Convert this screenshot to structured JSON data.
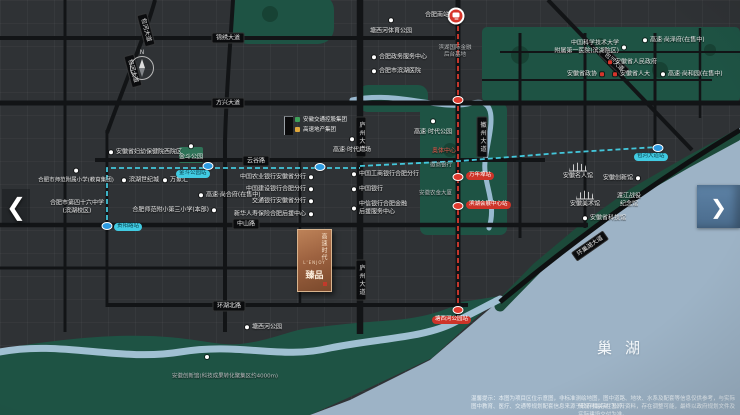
{
  "lake_label": "巢湖",
  "compass_n": "N",
  "nav": {
    "prev": "❮",
    "next": "❯"
  },
  "plaque": {
    "vertical": "高速时代",
    "latin": "L'ENJOY",
    "name": "臻品"
  },
  "developer_logos": [
    {
      "label": "安徽交通控股集团",
      "color": "#3fa05a",
      "x": 295,
      "y": 119
    },
    {
      "label": "高速地产集团",
      "color": "#e0a83c",
      "x": 295,
      "y": 129
    }
  ],
  "disclaimer": {
    "line1": "温馨提示：本图为项目区位示意图，非标准测绘地图，图中道路、地块、水系及配套等信息仅供参考，与实际情况可能存在差异。",
    "line2": "图中教育、医疗、交通等规划配套信息来源于政府相关部门公开资料，存在调整可能，最终以政府规划文件及实际建设交付为准。"
  },
  "colors": {
    "metro_cyan": "#45cfe4",
    "metro_red": "#e33d30",
    "park": "#1e5344",
    "lake": "#9db3c6",
    "accent_red": "#d6352b"
  },
  "map": {
    "pois": [
      {
        "n": "hefei-south-station-label",
        "t": "合肥南站",
        "x": 449,
        "y": 15,
        "m": "none",
        "a": "r"
      },
      {
        "n": "tangxihe-sports-park-label",
        "t": "塘西河体育公园",
        "x": 391,
        "y": 31,
        "m": "wt",
        "a": "c"
      },
      {
        "n": "gov-service-center-label",
        "t": "合肥政务服务中心",
        "x": 372,
        "y": 57,
        "m": "wl",
        "a": "l"
      },
      {
        "n": "binhu-hospital-label",
        "t": "合肥市滨湖医院",
        "x": 372,
        "y": 71,
        "m": "wl",
        "a": "l"
      },
      {
        "n": "financial-backoffice-label",
        "t": "滨湖国际金融\n后台基地",
        "x": 455,
        "y": 52,
        "m": "none",
        "a": "c",
        "cls": "grey sm"
      },
      {
        "n": "ustc-hospital-label",
        "t": "中国科学技术大学\n附属第一医院(滨湖院区)",
        "x": 626,
        "y": 47,
        "m": "wr",
        "a": "r"
      },
      {
        "n": "gaosu-shangzefu-label",
        "t": "高速·尚泽府(在售中)",
        "x": 643,
        "y": 40,
        "m": "wl",
        "a": "l"
      },
      {
        "n": "anhui-gov-label",
        "t": "安徽省人民政府",
        "x": 608,
        "y": 62,
        "m": "rl",
        "a": "l"
      },
      {
        "n": "anhui-zhengxie-label",
        "t": "安徽省政协",
        "x": 604,
        "y": 74,
        "m": "rr",
        "a": "r"
      },
      {
        "n": "anhui-renda-label",
        "t": "安徽省人大",
        "x": 613,
        "y": 74,
        "m": "rl",
        "a": "l"
      },
      {
        "n": "gaosu-shangheyuan-label",
        "t": "高速·尚和园(在售中)",
        "x": 661,
        "y": 74,
        "m": "wl",
        "a": "l"
      },
      {
        "n": "abc-bank-label",
        "t": "中国农业银行安徽省分行",
        "x": 313,
        "y": 177,
        "m": "wr",
        "a": "r"
      },
      {
        "n": "ccb-bank-label",
        "t": "中国建设银行合肥分行",
        "x": 313,
        "y": 189,
        "m": "wr",
        "a": "r"
      },
      {
        "n": "bocom-bank-label",
        "t": "交通银行安徽省分行",
        "x": 313,
        "y": 201,
        "m": "wr",
        "a": "r"
      },
      {
        "n": "xinhua-insurance-label",
        "t": "新华人寿保险合肥后援中心",
        "x": 313,
        "y": 214,
        "m": "wr",
        "a": "r"
      },
      {
        "n": "icbc-bank-label",
        "t": "中国工商银行合肥分行",
        "x": 352,
        "y": 174,
        "m": "wl",
        "a": "l"
      },
      {
        "n": "boc-bank-label",
        "t": "中国银行",
        "x": 352,
        "y": 189,
        "m": "wl",
        "a": "l"
      },
      {
        "n": "citic-bank-label",
        "t": "中信银行合肥金融\n后援服务中心",
        "x": 352,
        "y": 208,
        "m": "wl",
        "a": "l"
      },
      {
        "n": "huishang-bank-label",
        "t": "徽商银行",
        "x": 452,
        "y": 166,
        "m": "none",
        "a": "r",
        "cls": "sm grey"
      },
      {
        "n": "nongjin-tower-label",
        "t": "安徽农金大厦",
        "x": 452,
        "y": 194,
        "m": "none",
        "a": "r",
        "cls": "sm grey"
      },
      {
        "n": "gaosu-times-square-label",
        "t": "高速·时代广场",
        "x": 352,
        "y": 150,
        "m": "wt",
        "a": "c"
      },
      {
        "n": "gaosu-times-park-label",
        "t": "高速·时代公园",
        "x": 433,
        "y": 132,
        "m": "wt",
        "a": "c"
      },
      {
        "n": "sports-center-label",
        "t": "奥体中心",
        "x": 444,
        "y": 151,
        "m": "none",
        "a": "c",
        "cls": "red"
      },
      {
        "n": "maternity-hospital-label",
        "t": "安徽省妇幼保健院西院区",
        "x": 109,
        "y": 152,
        "m": "wl",
        "a": "l"
      },
      {
        "n": "jindou-park-label",
        "t": "金斗公园",
        "x": 191,
        "y": 157,
        "m": "wt",
        "a": "c"
      },
      {
        "n": "binhu-century-city-label",
        "t": "滨湖世纪城",
        "x": 122,
        "y": 180,
        "m": "wl",
        "a": "l"
      },
      {
        "n": "wanxianghui-label",
        "t": "万象汇",
        "x": 163,
        "y": 180,
        "m": "wl",
        "a": "l"
      },
      {
        "n": "gaosu-shanghefu-label",
        "t": "高速·尚合府(在售中)",
        "x": 199,
        "y": 195,
        "m": "wl",
        "a": "l"
      },
      {
        "n": "normal-primary-school-label",
        "t": "合肥师范附小第三小学(本部)",
        "x": 216,
        "y": 210,
        "m": "wr",
        "a": "r"
      },
      {
        "n": "normal-attached-primary-label",
        "t": "合肥市师范附属小学(教育集团)",
        "x": 76,
        "y": 181,
        "m": "wt",
        "a": "c",
        "cls": "sm"
      },
      {
        "n": "no46-middle-school-label",
        "t": "合肥市第四十六中学\n(滨湖校区)",
        "x": 77,
        "y": 207,
        "m": "none",
        "a": "c"
      },
      {
        "n": "tangxihe-park-label",
        "t": "塘西河公园",
        "x": 245,
        "y": 327,
        "m": "wl",
        "a": "l"
      },
      {
        "n": "anhui-innovation-hall-note",
        "t": "安徽创新馆(科技成果转化聚集区约4000m)",
        "x": 225,
        "y": 377,
        "m": "none",
        "a": "c",
        "cls": "sm grey"
      },
      {
        "n": "celebrity-hall-label",
        "t": "安徽名人馆",
        "x": 578,
        "y": 176,
        "m": "none",
        "a": "c"
      },
      {
        "n": "innovation-hall-label",
        "t": "安徽创新馆",
        "x": 640,
        "y": 178,
        "m": "wr",
        "a": "r"
      },
      {
        "n": "art-museum-label",
        "t": "安徽美术馆",
        "x": 585,
        "y": 204,
        "m": "none",
        "a": "c"
      },
      {
        "n": "dujiang-memorial-label",
        "t": "渡江战役\n纪念馆",
        "x": 629,
        "y": 200,
        "m": "none",
        "a": "c"
      },
      {
        "n": "science-museum-label",
        "t": "安徽省科技馆",
        "x": 583,
        "y": 218,
        "m": "wl",
        "a": "l"
      }
    ],
    "road_pills": [
      {
        "t": "锦绣大道",
        "x": 228,
        "y": 38
      },
      {
        "t": "方兴大道",
        "x": 228,
        "y": 103
      },
      {
        "t": "云谷路",
        "x": 256,
        "y": 161
      },
      {
        "t": "中山路",
        "x": 246,
        "y": 224
      },
      {
        "t": "环湖北路",
        "x": 229,
        "y": 306
      },
      {
        "t": "庐州大道",
        "x": 361,
        "y": 137,
        "vert": true
      },
      {
        "t": "庐州大道",
        "x": 361,
        "y": 280,
        "vert": true
      },
      {
        "t": "徽州大道",
        "x": 482,
        "y": 137,
        "vert": true
      },
      {
        "t": "包河大道",
        "x": 146,
        "y": 30,
        "rot": 75
      },
      {
        "t": "包河大道",
        "x": 133,
        "y": 71,
        "rot": 75
      },
      {
        "t": "包河大道",
        "x": 614,
        "y": 62,
        "rot": 43
      },
      {
        "t": "环巢湖大道",
        "x": 590,
        "y": 246,
        "rot": -35
      }
    ],
    "metro_pills": [
      {
        "t": "金斗公园站",
        "x": 176,
        "y": 170,
        "k": "cyan",
        "n": "jindou-park-station-pill"
      },
      {
        "t": "贵阳路站",
        "x": 114,
        "y": 223,
        "k": "cyan",
        "n": "guiyang-road-station-pill"
      },
      {
        "t": "包河大道站",
        "x": 634,
        "y": 153,
        "k": "cyan",
        "n": "baohe-avenue-station-pill"
      },
      {
        "t": "万年埠站",
        "x": 466,
        "y": 172,
        "k": "red",
        "n": "wannianbu-station-pill"
      },
      {
        "t": "滨湖会展中心站",
        "x": 466,
        "y": 201,
        "k": "red",
        "n": "convention-center-station-pill"
      },
      {
        "t": "塘西河公园站",
        "x": 432,
        "y": 316,
        "k": "red",
        "n": "tangxihe-park-station-pill"
      }
    ],
    "stations": {
      "blue": [
        [
          208,
          166
        ],
        [
          320,
          167
        ],
        [
          658,
          148
        ],
        [
          107,
          226
        ]
      ],
      "red": [
        [
          458,
          100
        ],
        [
          458,
          177
        ],
        [
          458,
          206
        ],
        [
          458,
          310
        ]
      ],
      "dots": [
        [
          207,
          357
        ]
      ]
    },
    "building_icons": [
      [
        578,
        167
      ],
      [
        585,
        195
      ]
    ]
  }
}
